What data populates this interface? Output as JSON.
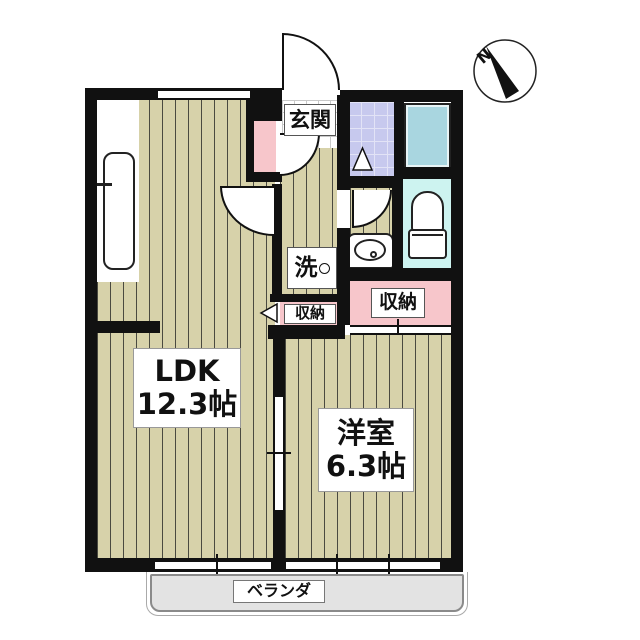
{
  "plan": {
    "compass_label": "N",
    "rooms": {
      "entrance": {
        "label": "玄関"
      },
      "ldk": {
        "line1": "LDK",
        "line2": "12.3帖"
      },
      "western_room": {
        "line1": "洋室",
        "line2": "6.3帖"
      },
      "laundry": {
        "label": "洗"
      },
      "closet_small": {
        "label": "収納"
      },
      "closet_large": {
        "label": "収納"
      },
      "veranda": {
        "label": "ベランダ"
      }
    },
    "fixtures": [
      "kitchen-sink",
      "shoe-cabinet",
      "bathtub",
      "toilet",
      "washbasin",
      "washing-machine-space"
    ],
    "colors": {
      "wall": "#111111",
      "flooring": "#d7d2aa",
      "closet_pink": "#f7c6cb",
      "bath_tile": "#c7c9ee",
      "bathtub_fill": "#a9d6e0",
      "toilet_floor": "#cdf3f0",
      "balcony_fill": "#e3e3e3"
    }
  }
}
